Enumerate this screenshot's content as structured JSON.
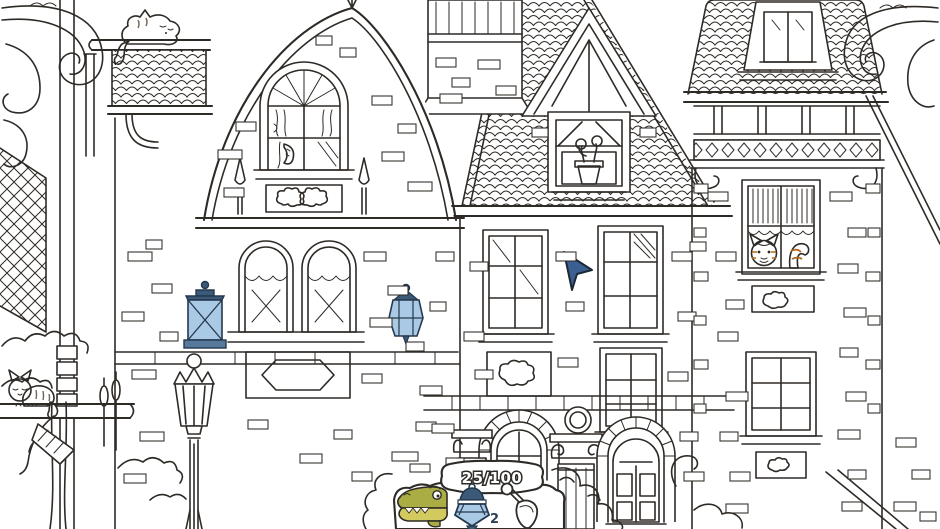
{
  "hud": {
    "progress": {
      "found": "25",
      "total": "100",
      "display": "25/100"
    },
    "tray": {
      "items": [
        {
          "id": "crocodile",
          "label": "crocodile",
          "found": true,
          "count_label": ""
        },
        {
          "id": "lantern",
          "label": "lantern",
          "found": true,
          "count_label": "2"
        },
        {
          "id": "shovel",
          "label": "shovel",
          "found": false,
          "count_label": ""
        }
      ]
    }
  },
  "scene": {
    "description": "hand-drawn line-art Victorian mansion coloring page (hidden-object scene)",
    "objects": [
      {
        "name": "sleeping-cat-on-roof-ledge",
        "color": "#a5917b",
        "colored": true
      },
      {
        "name": "gray-cat-on-platform",
        "color": "#9e948a",
        "colored": true
      },
      {
        "name": "orange-cat-in-window",
        "color": "#ef9a3e",
        "colored": true
      },
      {
        "name": "pickle-in-gable-window",
        "color": "#b3ab3e",
        "colored": true
      },
      {
        "name": "flower-pot-in-dormer-window",
        "color": "#e6c63e",
        "colored": true
      },
      {
        "name": "blue-wall-lantern-left",
        "color": "#a9c9e4",
        "colored": true
      },
      {
        "name": "blue-wall-lantern-right",
        "color": "#9fc2e0",
        "colored": true
      },
      {
        "name": "street-lamp",
        "color": "",
        "colored": false
      },
      {
        "name": "cursor-arrow",
        "color": "#3c5f92",
        "colored": true
      }
    ]
  },
  "colors": {
    "ink": "#2e2a26",
    "paper": "#ffffff",
    "lantern_glass": "#a9c9e4",
    "lantern_cap": "#3b5a7a",
    "cat_orange": "#ef9a3e",
    "cat_orange_stripe": "#b5661f",
    "cat_gray": "#9e948a",
    "cat_brown": "#a5917b",
    "croc_green": "#a9ad43",
    "croc_jaw": "#d2c95f",
    "cursor_blue": "#3c5f92",
    "pot_yellow": "#e6c63e",
    "flower_red": "#7c2b50",
    "stem_green": "#4e7a2e",
    "pickle_olive": "#b3ab3e"
  }
}
